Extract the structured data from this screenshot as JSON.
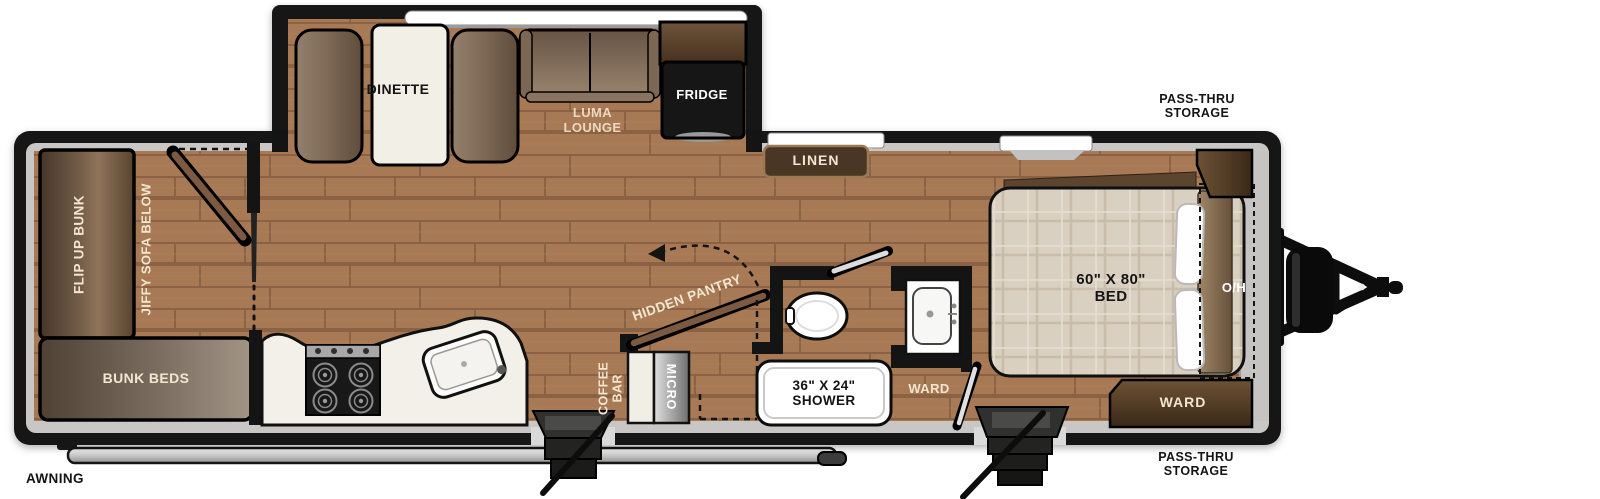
{
  "floorplan": {
    "type": "travel-trailer-floorplan",
    "slideout": {
      "dinette": "DINETTE",
      "lounge": {
        "line1": "LUMA",
        "line2": "LOUNGE"
      },
      "fridge": "FRIDGE"
    },
    "bunk_room": {
      "flip_up_bunk": "FLIP UP BUNK",
      "jiffy_sofa": "JIFFY SOFA BELOW",
      "bunk_beds": "BUNK BEDS"
    },
    "kitchen": {
      "hidden_pantry": "HIDDEN PANTRY",
      "coffee_bar": {
        "line1": "COFFEE",
        "line2": "BAR"
      },
      "micro": "MICRO"
    },
    "bathroom": {
      "shower": {
        "line1": "36\" X 24\"",
        "line2": "SHOWER"
      },
      "ward": "WARD"
    },
    "bedroom": {
      "linen": "LINEN",
      "bed": {
        "line1": "60\" X 80\"",
        "line2": "BED"
      },
      "overhead": "O/H",
      "ward": "WARD"
    },
    "exterior": {
      "awning": "AWNING",
      "pass_thru_top": {
        "line1": "PASS-THRU",
        "line2": "STORAGE"
      },
      "pass_thru_bottom": {
        "line1": "PASS-THRU",
        "line2": "STORAGE"
      }
    },
    "colors": {
      "wall": "#141414",
      "floor": "#a77a55",
      "rim": "#c9c7c5",
      "cabinet_dark": "#4a3625",
      "counter": "#f3f0e9",
      "mattress": "#dad0c1",
      "label_cream": "#f2e6d0"
    }
  }
}
